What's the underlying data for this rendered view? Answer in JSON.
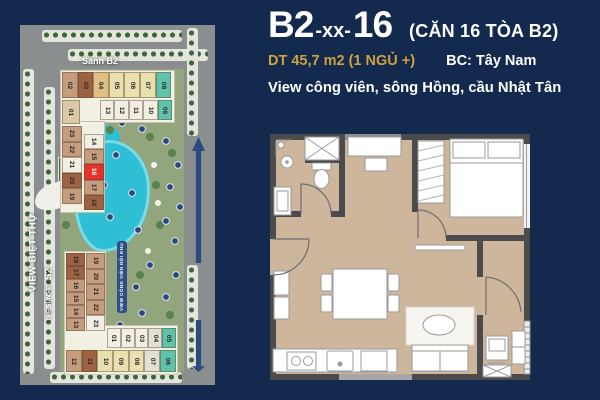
{
  "colors": {
    "bg": "#13294d",
    "gold": "#cda33f",
    "unit_red": "#e5332a",
    "pool": "#2fbfd4",
    "wall": "#4b4b4d",
    "floor": "#cdb69c"
  },
  "header": {
    "code_prefix": "B2",
    "code_middle": "-xx-",
    "code_suffix": "16",
    "code_note": "(CĂN 16 TÒA B2)",
    "area": "DT  45,7 m2  (1 NGỦ +)",
    "balcony_direction": "BC: Tây Nam",
    "view_note": "View công viên, sông Hồng, cầu Nhật Tân"
  },
  "site_map": {
    "lobby_label": "Sảnh B2",
    "left_view_label": "VIEW BIỆT THỰ",
    "park_view_label": "VIEW CÔNG VIÊN NỘI KHU",
    "sunset_label": "THE SUNSET",
    "sunset_code": "S2",
    "highlighted_unit": "16",
    "palette": {
      "tan": "#c59c7c",
      "brown": "#9c6242",
      "gold": "#dfc183",
      "cream": "#eadfae",
      "white": "#f2eee1",
      "teal": "#5fc3a9",
      "red": "#e5332a",
      "ltan": "#dcc9a6",
      "gray": "#e2dfd3"
    },
    "b2_top_row": [
      {
        "n": "02",
        "c": "tan"
      },
      {
        "n": "03",
        "c": "brown"
      },
      {
        "n": "04",
        "c": "gold"
      },
      {
        "n": "05",
        "c": "cream"
      },
      {
        "n": "06",
        "c": "cream"
      },
      {
        "n": "07",
        "c": "cream"
      },
      {
        "n": "08",
        "c": "teal"
      }
    ],
    "b2_mid_row": [
      {
        "n": "13",
        "c": "white"
      },
      {
        "n": "12",
        "c": "white"
      },
      {
        "n": "11",
        "c": "white"
      },
      {
        "n": "10",
        "c": "white"
      },
      {
        "n": "09",
        "c": "teal"
      }
    ],
    "b2_unit_01": [
      {
        "n": "01",
        "c": "ltan"
      }
    ],
    "b2_outer_col": [
      {
        "n": "23",
        "c": "tan"
      },
      {
        "n": "22",
        "c": "tan"
      },
      {
        "n": "21",
        "c": "white"
      },
      {
        "n": "20",
        "c": "brown"
      },
      {
        "n": "19",
        "c": "tan"
      }
    ],
    "b2_inner_col": [
      {
        "n": "14",
        "c": "white"
      },
      {
        "n": "15",
        "c": "tan"
      },
      {
        "n": "16",
        "c": "red",
        "hl": true
      },
      {
        "n": "17",
        "c": "tan"
      },
      {
        "n": "18",
        "c": "brown"
      }
    ],
    "s2_outer_col": [
      {
        "n": "18",
        "c": "brown"
      },
      {
        "n": "17",
        "c": "brown"
      },
      {
        "n": "16",
        "c": "tan"
      },
      {
        "n": "15",
        "c": "tan"
      },
      {
        "n": "14",
        "c": "tan"
      },
      {
        "n": "13",
        "c": "tan"
      }
    ],
    "s2_inner_col": [
      {
        "n": "19",
        "c": "tan"
      },
      {
        "n": "20",
        "c": "tan"
      },
      {
        "n": "21",
        "c": "tan"
      },
      {
        "n": "22",
        "c": "tan"
      },
      {
        "n": "23",
        "c": "white"
      }
    ],
    "s2_upper_row": [
      {
        "n": "01",
        "c": "white"
      },
      {
        "n": "02",
        "c": "white"
      },
      {
        "n": "03",
        "c": "white"
      },
      {
        "n": "04",
        "c": "gray"
      },
      {
        "n": "05",
        "c": "teal"
      }
    ],
    "s2_lower_row": [
      {
        "n": "12",
        "c": "tan"
      },
      {
        "n": "11",
        "c": "brown"
      },
      {
        "n": "10",
        "c": "cream"
      },
      {
        "n": "09",
        "c": "cream"
      },
      {
        "n": "08",
        "c": "cream"
      },
      {
        "n": "07",
        "c": "gray"
      },
      {
        "n": "06",
        "c": "teal"
      }
    ]
  }
}
